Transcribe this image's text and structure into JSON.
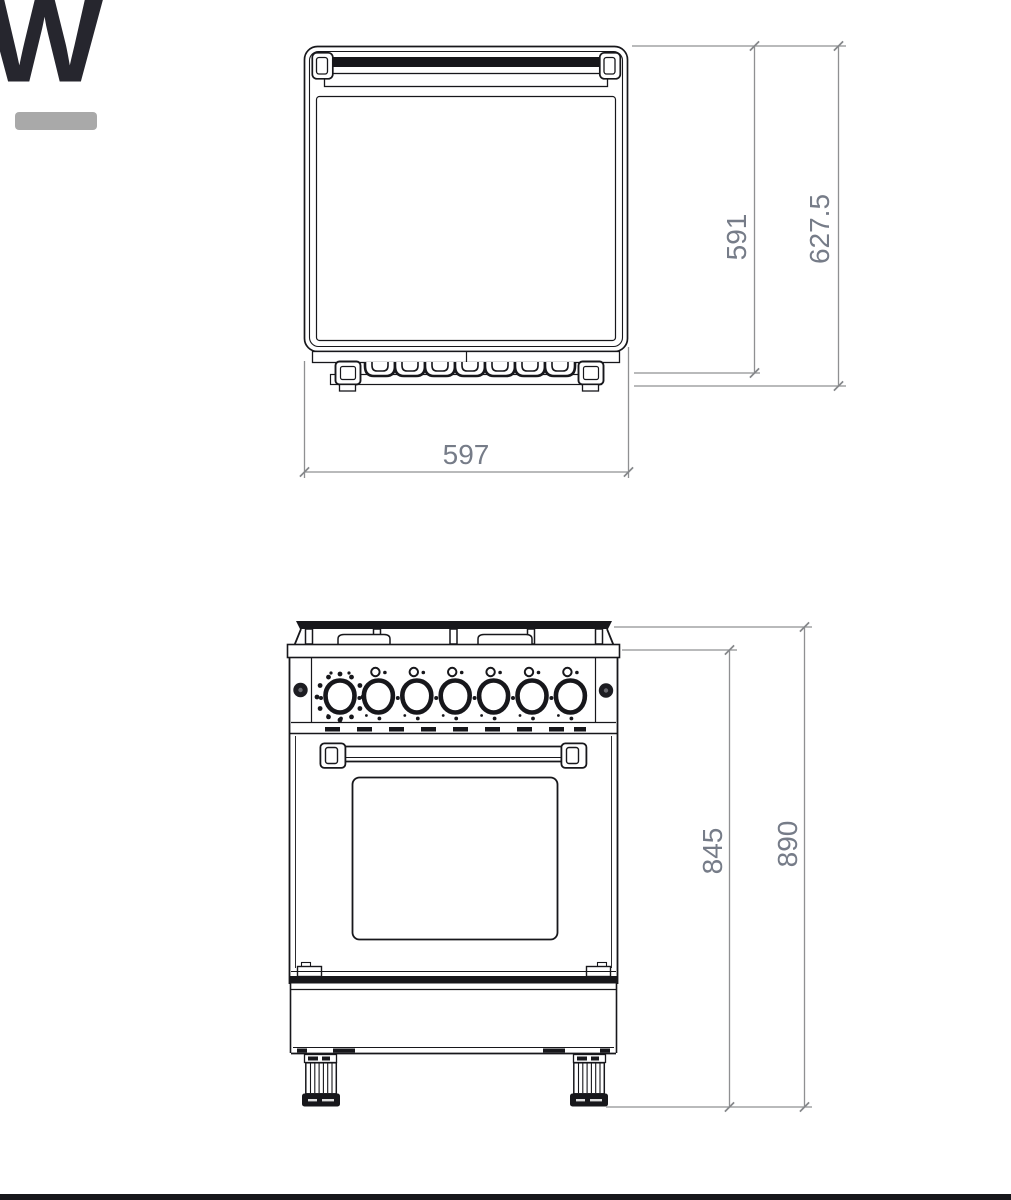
{
  "page": {
    "background_color": "#ffffff",
    "bottom_bar_color": "#17171b"
  },
  "logo": {
    "letter": "W",
    "letter_color": "#26262e",
    "underline_color": "#a9a9a9"
  },
  "drawing": {
    "type": "technical-dimension-diagram",
    "subject": "freestanding cooker with oven, two views",
    "line_color": "#17171b",
    "dimension_line_color": "#8f9092",
    "dimension_text_color": "#767c88",
    "top_view": {
      "name": "top view",
      "dimensions": {
        "width": "597",
        "depth_body": "591",
        "depth_total": "627.5"
      }
    },
    "front_view": {
      "name": "front view",
      "knob_count": 7,
      "dimensions": {
        "height_body": "845",
        "height_total": "890"
      }
    }
  }
}
